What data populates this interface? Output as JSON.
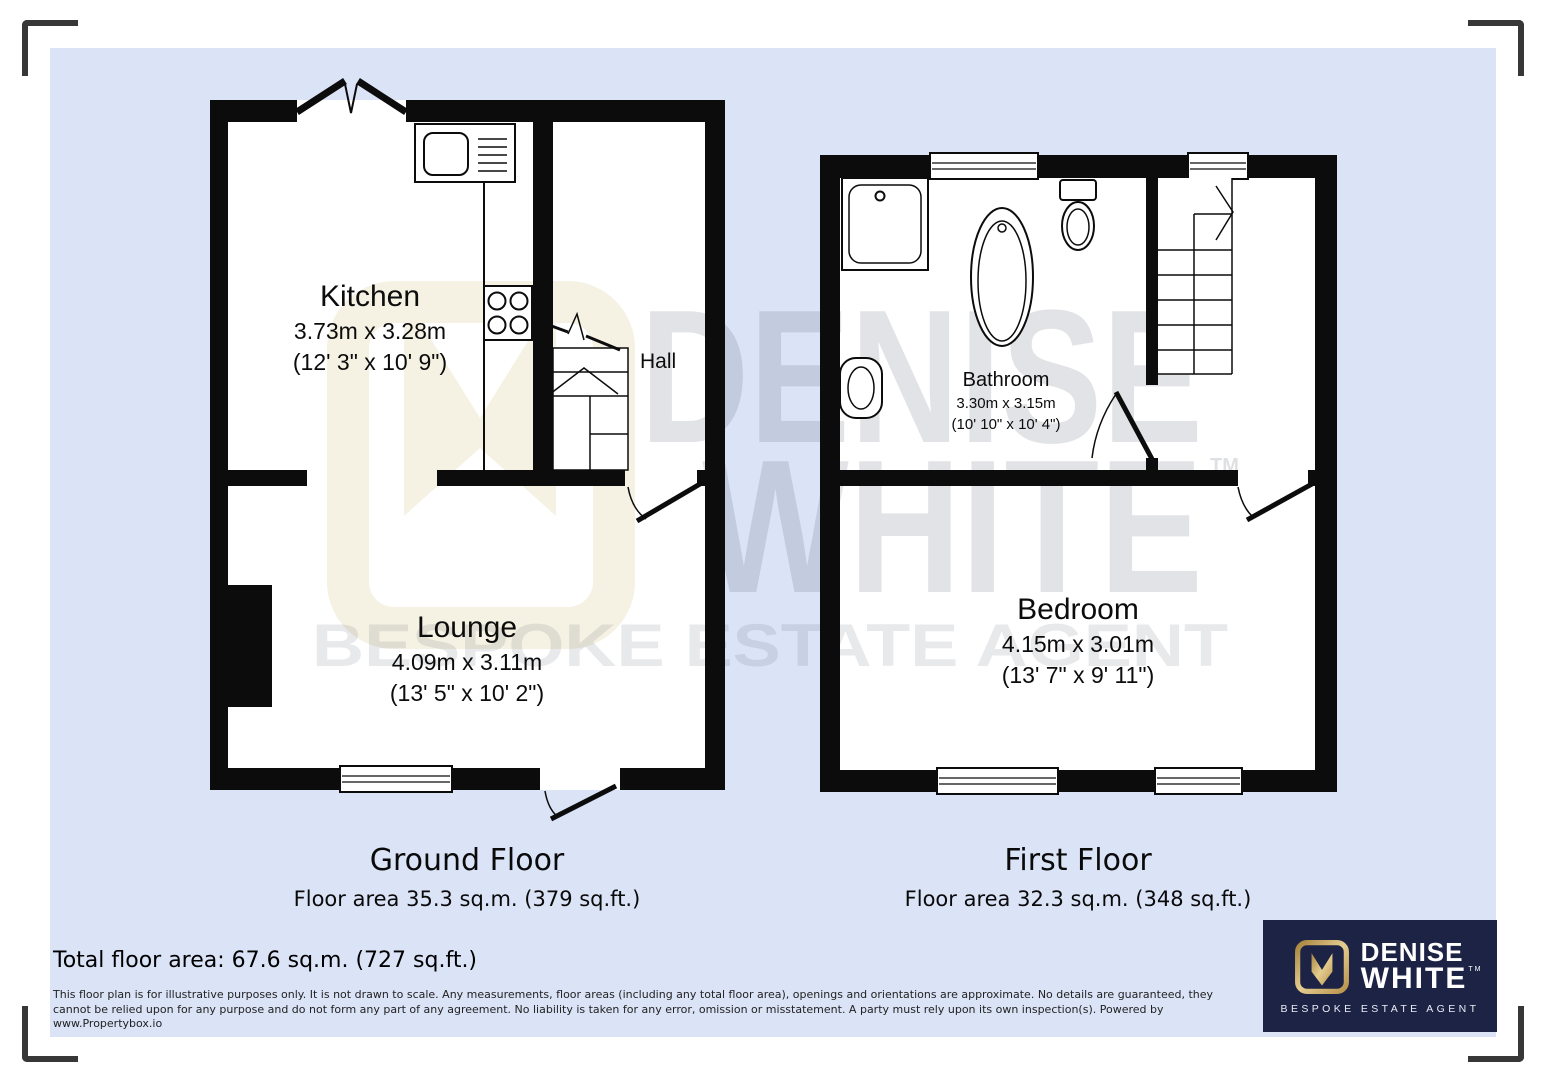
{
  "floorplan": {
    "ground_floor": {
      "title": "Ground Floor",
      "area": "Floor area 35.3 sq.m. (379 sq.ft.)",
      "rooms": [
        {
          "name": "Kitchen",
          "dims_m": "3.73m x 3.28m",
          "dims_ft": "(12' 3\" x 10' 9\")"
        },
        {
          "name": "Hall"
        },
        {
          "name": "Lounge",
          "dims_m": "4.09m x 3.11m",
          "dims_ft": "(13' 5\" x 10' 2\")"
        }
      ]
    },
    "first_floor": {
      "title": "First Floor",
      "area": "Floor area 32.3 sq.m. (348 sq.ft.)",
      "rooms": [
        {
          "name": "Bathroom",
          "dims_m": "3.30m x 3.15m",
          "dims_ft": "(10' 10\" x 10' 4\")"
        },
        {
          "name": "Bedroom",
          "dims_m": "4.15m x 3.01m",
          "dims_ft": "(13' 7\" x 9' 11\")"
        }
      ]
    },
    "total_area": "Total floor area: 67.6 sq.m. (727 sq.ft.)",
    "disclaimer": "This floor plan is for illustrative purposes only. It is not drawn to scale. Any measurements, floor areas (including any total floor area), openings and orientations are approximate. No details are guaranteed, they cannot be relied upon for any purpose and do not form any part of any agreement. No liability is taken for any error, omission or misstatement. A party must rely upon its own inspection(s). Powered by www.Propertybox.io"
  },
  "watermark": {
    "line1": "DENISE",
    "line2": "WHITE",
    "tagline": "BESPOKE ESTATE AGENT",
    "tm": "TM"
  },
  "logo": {
    "line1": "DENISE",
    "line2": "WHITE",
    "tagline": "BESPOKE ESTATE AGENT",
    "tm": "TM"
  },
  "colors": {
    "canvas_bg": "#dbe3f7",
    "wall": "#0c0c0c",
    "logo_navy": "#1c2344",
    "logo_gold": "#c9a55e",
    "watermark_cream": "#f5f1e3"
  }
}
